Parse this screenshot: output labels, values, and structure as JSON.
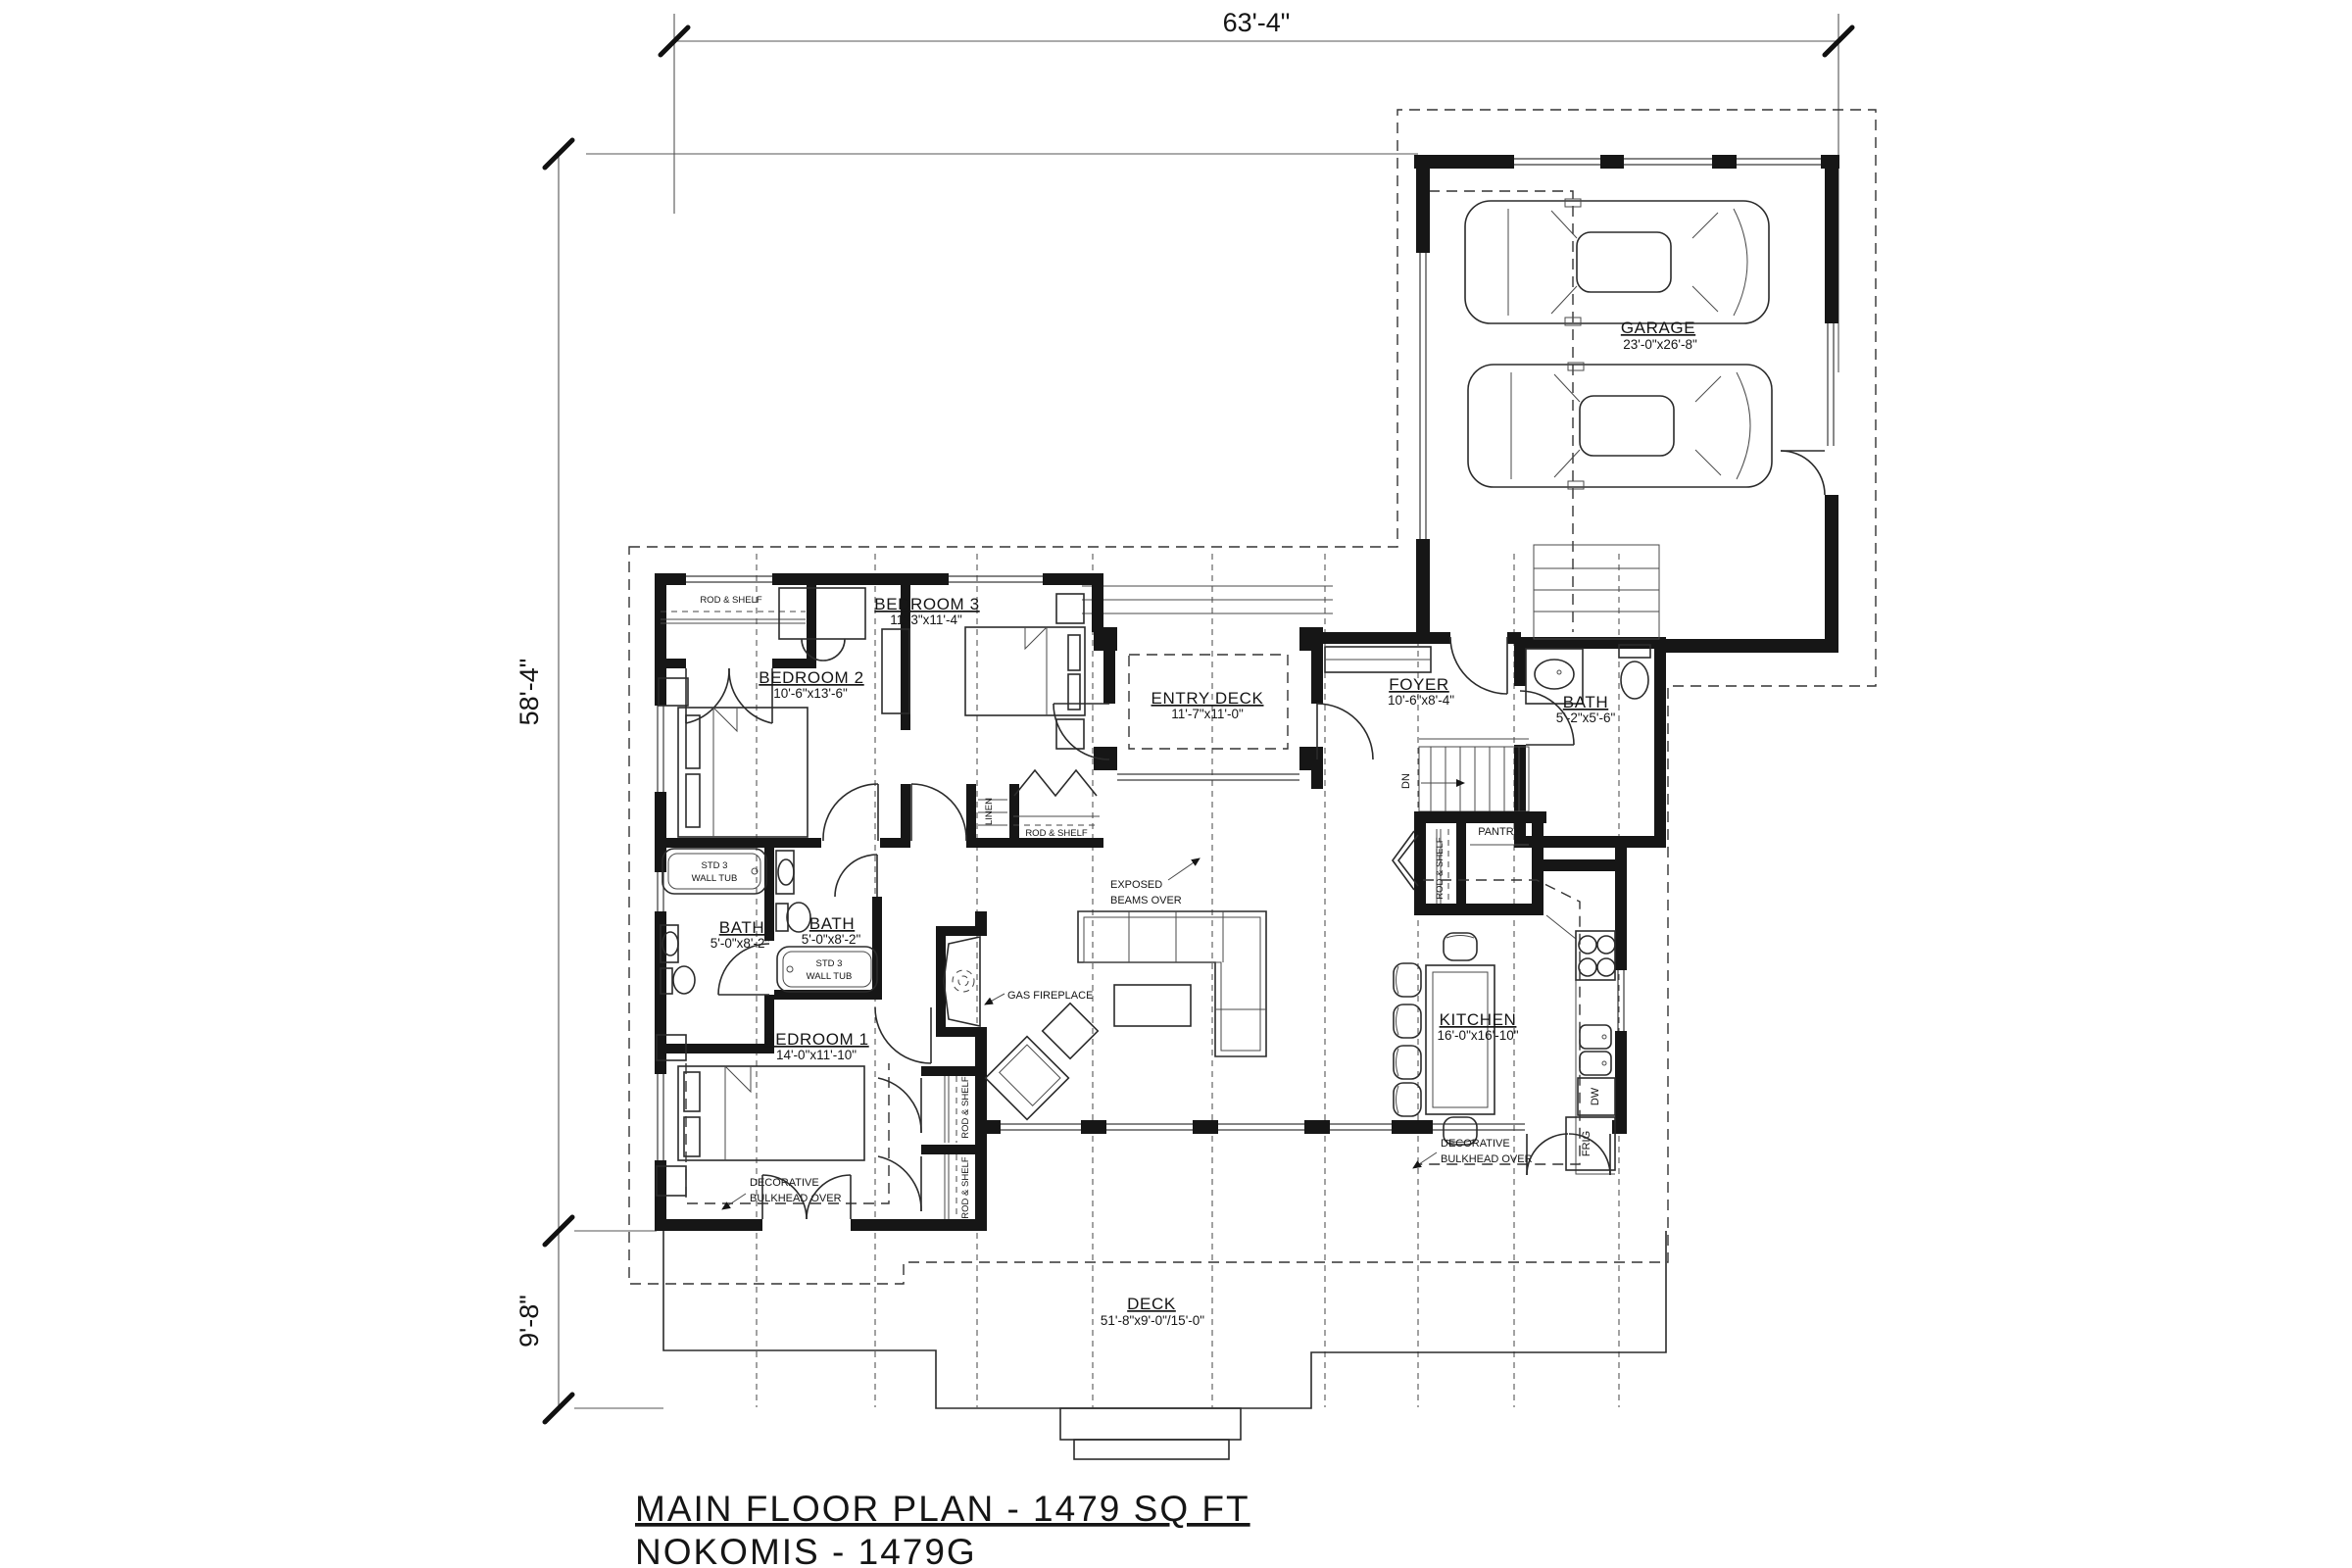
{
  "title": {
    "line1": "MAIN FLOOR PLAN - 1479 SQ FT",
    "line2": "NOKOMIS - 1479G"
  },
  "dimensions": {
    "top_width": "63'-4\"",
    "left_height": "58'-4\"",
    "deck_depth": "9'-8\""
  },
  "rooms": {
    "garage": {
      "name": "GARAGE",
      "size": "23'-0\"x26'-8\""
    },
    "entry_deck": {
      "name": "ENTRY DECK",
      "size": "11'-7\"x11'-0\""
    },
    "foyer": {
      "name": "FOYER",
      "size": "10'-6\"x8'-4\""
    },
    "bath_hall": {
      "name": "BATH",
      "size": "5'-2\"x5'-6\""
    },
    "kitchen": {
      "name": "KITCHEN",
      "size": "16'-0\"x16'-10\""
    },
    "bedroom1": {
      "name": "BEDROOM 1",
      "size": "14'-0\"x11'-10\""
    },
    "bedroom2": {
      "name": "BEDROOM 2",
      "size": "10'-6\"x13'-6\""
    },
    "bedroom3": {
      "name": "BEDROOM 3",
      "size": "11'-3\"x11'-4\""
    },
    "bath_main": {
      "name": "BATH",
      "size": "5'-0\"x8'-2\""
    },
    "bath_ensuite": {
      "name": "BATH",
      "size": "5'-0\"x8'-2\""
    },
    "deck": {
      "name": "DECK",
      "size": "51'-8\"x9'-0\"/15'-0\""
    },
    "pantry": {
      "name": "PANTRY"
    },
    "linen": {
      "name": "LINEN"
    }
  },
  "annotations": {
    "rod_shelf": "ROD & SHELF",
    "tub_line1": "STD 3",
    "tub_line2": "WALL TUB",
    "gas_fireplace": "GAS FIREPLACE",
    "exposed_beams_line1": "EXPOSED",
    "exposed_beams_line2": "BEAMS OVER",
    "bulkhead_line1": "DECORATIVE",
    "bulkhead_line2": "BULKHEAD OVER",
    "stairs_down": "DN",
    "dishwasher": "DW",
    "fridge": "FRIG"
  },
  "colors": {
    "ink": "#161616",
    "background": "#ffffff"
  }
}
